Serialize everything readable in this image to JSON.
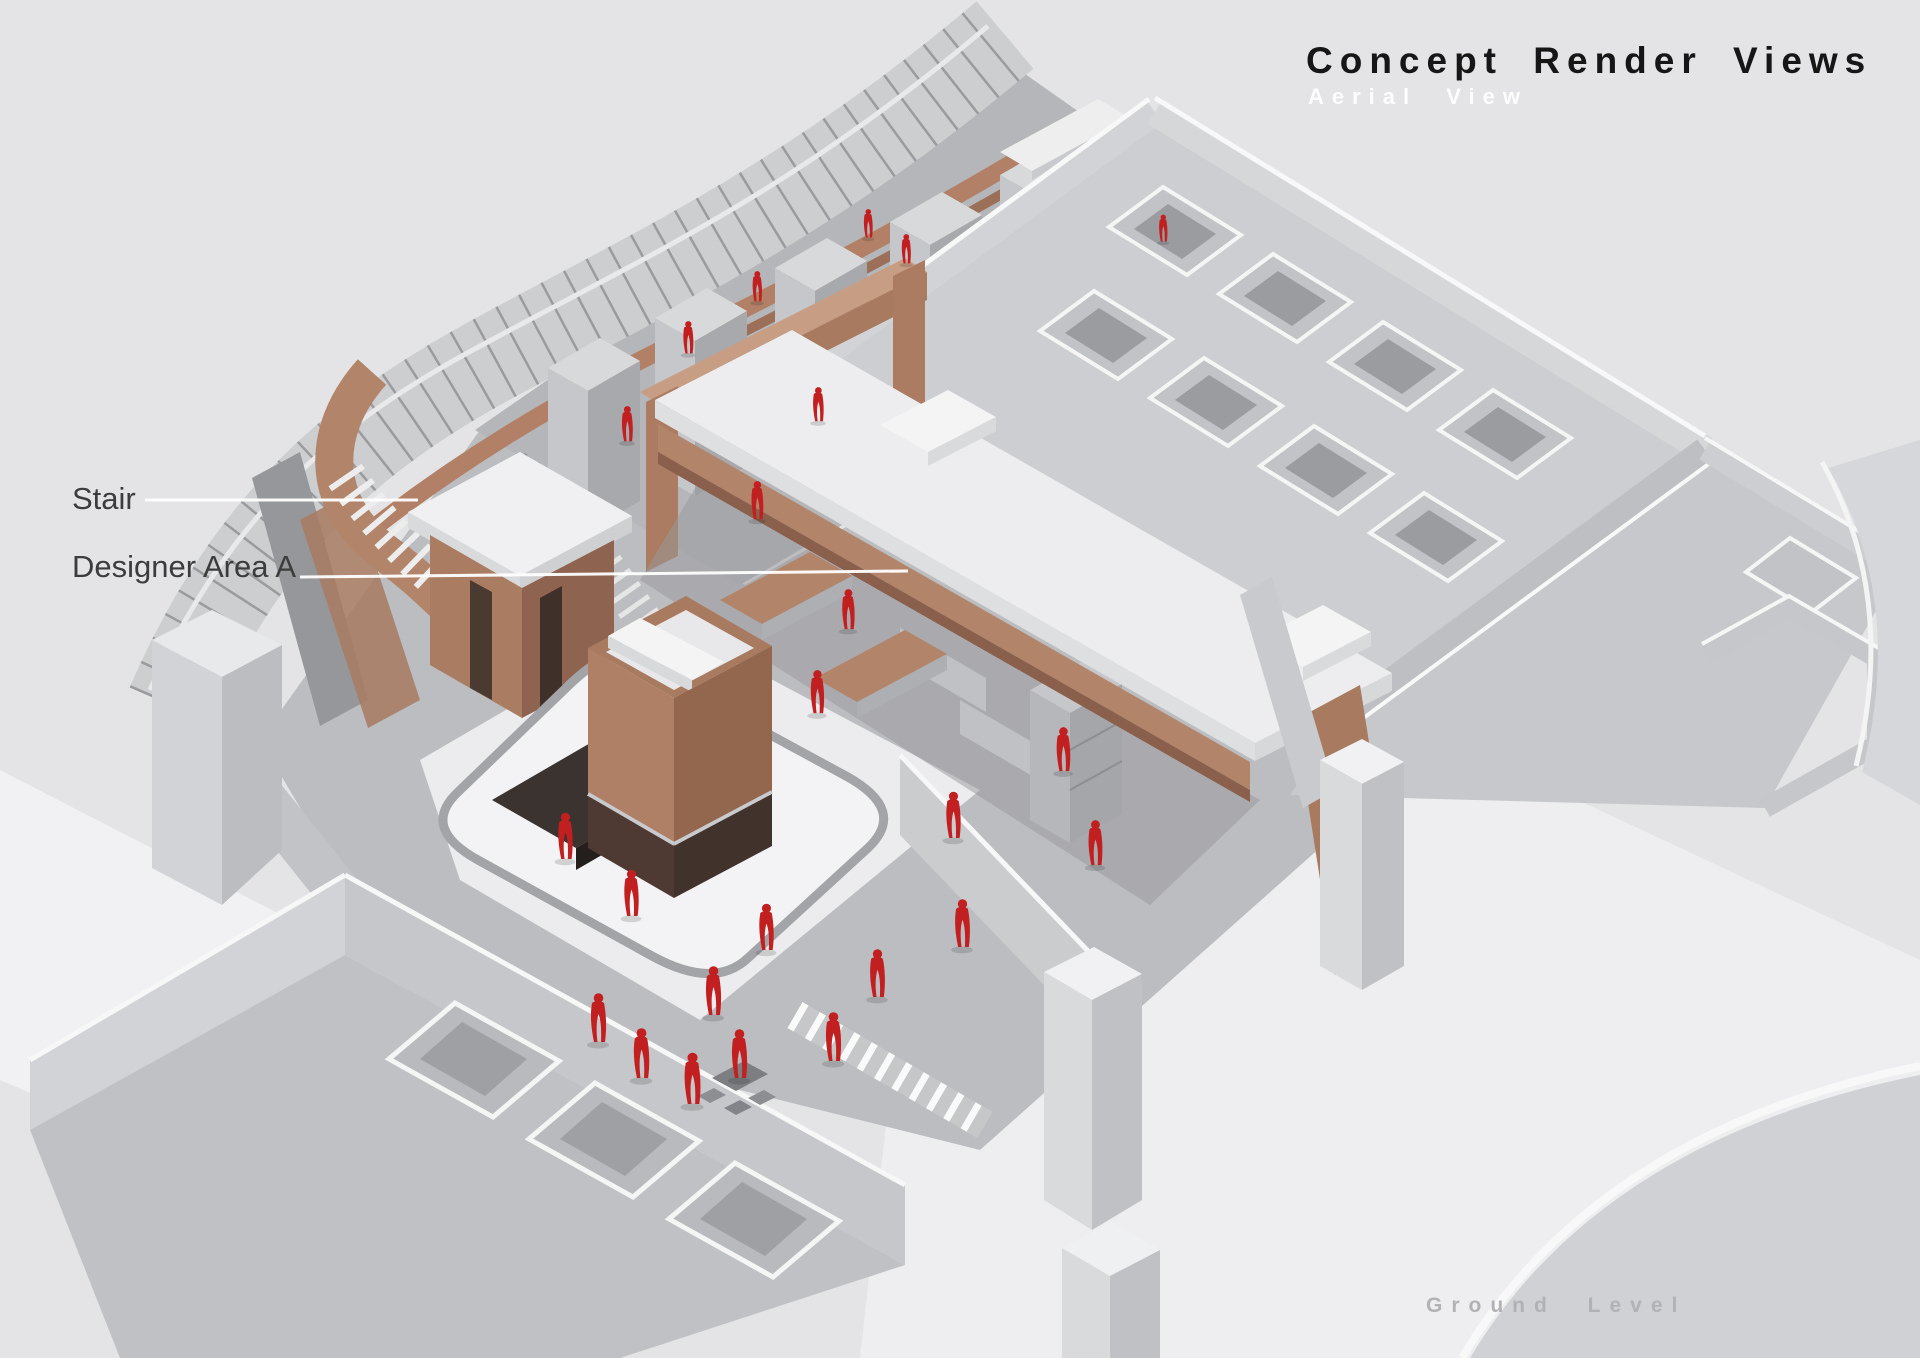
{
  "header": {
    "title": "Concept Render Views",
    "subtitle": "Aerial View"
  },
  "annotations": {
    "stair": {
      "label": "Stair"
    },
    "designer_area": {
      "label": "Designer Area A"
    }
  },
  "footer": {
    "level_label": "Ground Level"
  },
  "palette": {
    "background": "#e4e4e6",
    "floor_speckle_gray": "#b7b8bb",
    "floor_bright": "#f3f3f5",
    "wall_gray": "#c9cacd",
    "wall_edge_white": "#f8f8f9",
    "copper_light": "#c79d84",
    "copper": "#b2846a",
    "copper_dark": "#8e6350",
    "base_dark_brown": "#46332c",
    "figure_red": "#c22020",
    "title_color": "#161616",
    "subtitle_color": "#fdfdfd",
    "callout_color": "#3c3c3c",
    "footer_color": "#b2b2b6",
    "leader_line": "#ffffff"
  }
}
